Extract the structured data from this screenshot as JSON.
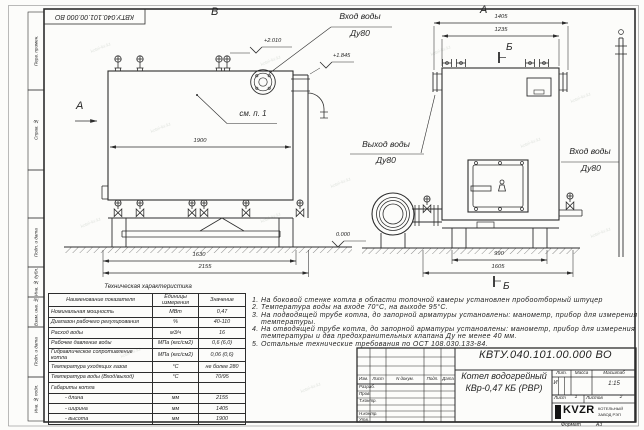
{
  "sheet": {
    "stamp_top_left": "КВТУ.040.101.00.000 ВО",
    "watermark": "kotel-kv.kz",
    "format_label": "Формат",
    "format_value": "А3",
    "margin_labels": [
      "Перв. примен.",
      "Справ. №",
      "Подп. и дата",
      "Инв. № дубл.",
      "Взам. инв. №",
      "Подп. и дата",
      "Инв. № подл."
    ]
  },
  "views": {
    "view_b_label": "В",
    "view_a_label": "А",
    "view_a_arrow_label": "А",
    "section_b_top": "Б",
    "section_b_bottom": "Б",
    "see_note": "см. п. 1",
    "inlet_top": {
      "line1": "Вход воды",
      "line2": "Ду80"
    },
    "outlet": {
      "line1": "Выход воды",
      "line2": "Ду80"
    },
    "inlet_right": {
      "line1": "Вход воды",
      "line2": "Ду80"
    },
    "elevations": {
      "e1": "+2.010",
      "e2": "+1.845",
      "zero": "0.000"
    },
    "dims": {
      "d1900": "1900",
      "d1630": "1630",
      "d2155": "2155",
      "d1405": "1405",
      "d1235": "1235",
      "d990": "990",
      "d1605": "1605"
    }
  },
  "table": {
    "title": "Техническая характеристика",
    "headers": [
      "Наименование показателя",
      "Единицы измерения",
      "Значение"
    ],
    "rows": [
      {
        "name": "Номинальная мощность",
        "unit": "МВт",
        "value": "0,47"
      },
      {
        "name": "Диапазон рабочего регулирования",
        "unit": "%",
        "value": "40-110"
      },
      {
        "name": "Расход воды",
        "unit": "м3/ч",
        "value": "16"
      },
      {
        "name": "Рабочее давление воды",
        "unit": "МПа (кгс/см2)",
        "value": "0,6 (6,0)"
      },
      {
        "name": "Гидравлическое сопротивление котла",
        "unit": "МПа (кгс/см2)",
        "value": "0,06 (0,6)"
      },
      {
        "name": "Температура уходящих газов",
        "unit": "°С",
        "value": "не более 280"
      },
      {
        "name": "Температура воды (Вход/выход)",
        "unit": "°С",
        "value": "70/95"
      },
      {
        "name": "Габариты котла",
        "unit": "",
        "value": ""
      },
      {
        "name": "- длина",
        "unit": "мм",
        "value": "2155"
      },
      {
        "name": "- ширина",
        "unit": "мм",
        "value": "1405"
      },
      {
        "name": "- высота",
        "unit": "мм",
        "value": "1900"
      }
    ]
  },
  "notes": [
    "1.  На боковой стенке котла в области топочной камеры установлен пробоотборный штуцер",
    "2.  Температура воды на входе 70°С, на выходе 95°С.",
    "3.  На подводящей трубе котла, до запорной арматуры установлены: манометр, прибор для измерения температуры.",
    "4.  На отводящей трубе котла, до запорной арматуры установлены: манометр, прибор для измерения температуры и два предохранительных клапана Ду не менее 40 мм.",
    "5.  Остальные технические требования по ОСТ 108.030.133-84."
  ],
  "title_block": {
    "designation": "КВТУ.040.101.00.000 ВО",
    "doc_name_line1": "Котел водогрейный",
    "doc_name_line2": "КВр-0,47 КБ (РВР)",
    "header_cols": [
      "Изм.",
      "Лист",
      "N докум.",
      "Подп.",
      "Дата"
    ],
    "sig_rows": [
      "Разраб.",
      "Пров.",
      "Т.контр.",
      "Н.контр.",
      "Утв."
    ],
    "lit_label": "Лит.",
    "mass_label": "Масса",
    "scale_label": "Масштаб",
    "lit_value": "И",
    "scale_value": "1:15",
    "sheet_label": "Лист",
    "sheet_value": "1",
    "sheets_label": "Листов",
    "sheets_value": "2",
    "logo_text": "KVZR",
    "logo_sub1": "КОТЕЛЬНЫЙ",
    "logo_sub2": "ЗАВОД РЭП"
  }
}
